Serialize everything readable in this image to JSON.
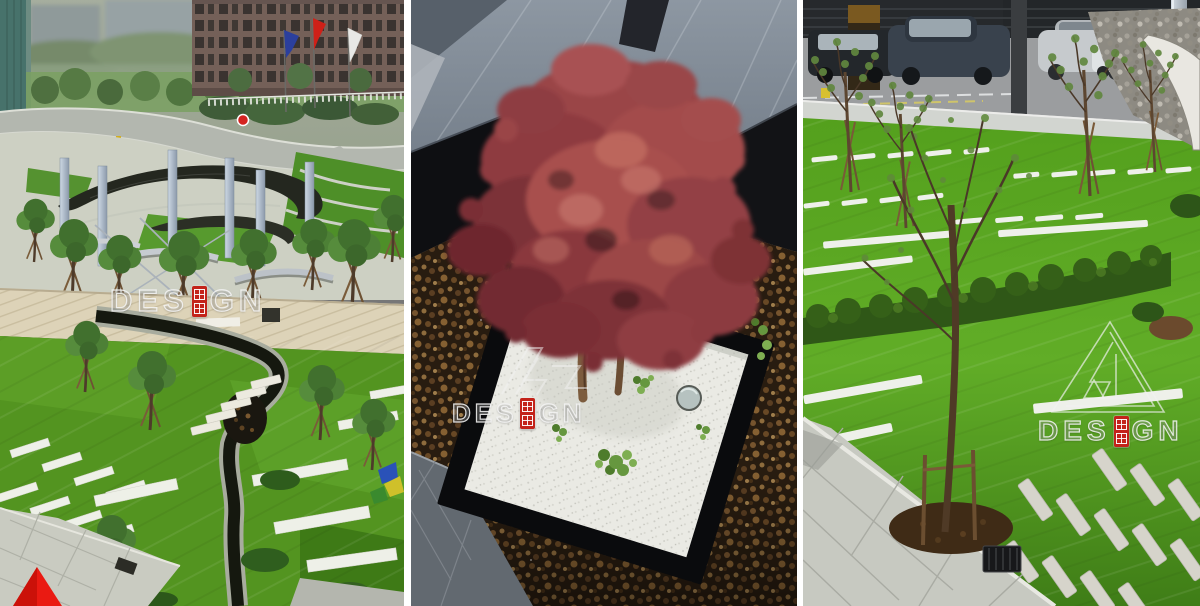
{
  "page": {
    "background_color": "#ffffff",
    "divider_color": "#ffffff"
  },
  "watermark": {
    "text": "DESIGN",
    "text_before_seal": "DES",
    "text_after_seal": "GN",
    "seal_color": "#c3231a",
    "outline_color": "#f4f4f4"
  },
  "brand": {
    "logo_shape": "triangle-monogram",
    "corner_mark_color": "#e81a12"
  },
  "panels": [
    {
      "alt": "Aerial view of a courtyard park with a spiral stone wall, steel pylons, lawns, a winding stream and stepping stones, flags and a brick building beyond"
    },
    {
      "alt": "Red Japanese maple planted in a black-edged square of white gravel set into a bed of wet brown pebbles beside dark stone steps"
    },
    {
      "alt": "Sloped lawn with rows of white stepping stones, young staked trees, a clipped hedge and parked cars along the street beyond"
    }
  ]
}
